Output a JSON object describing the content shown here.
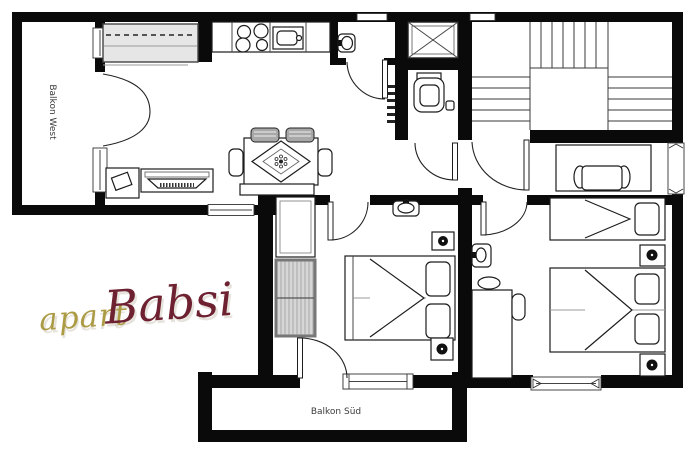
{
  "plan": {
    "labels": {
      "balcony_west": "Balkon West",
      "balcony_south": "Balkon Süd"
    },
    "logo": {
      "part1": "apart",
      "part2": "Babsi",
      "part1_color": "#ac9b45",
      "part2_color": "#6e2130",
      "shadow_color": "#c9c2b2"
    },
    "colors": {
      "wall": "#0a0a0a",
      "background": "#ffffff",
      "furniture_line": "#1c1c1c",
      "wardrobe_fill": "#d6d6d6",
      "sideboard_fill": "#e6e6e6",
      "label_text": "#3c3c3c"
    },
    "furniture_icons": [
      "kitchen-counter",
      "stove",
      "kitchen-sink",
      "shower",
      "toilet",
      "washbasin",
      "stairs",
      "dining-table",
      "dining-chair",
      "bench",
      "sideboard",
      "tv-board",
      "side-table",
      "double-bed",
      "single-bed",
      "wardrobe",
      "cabinet",
      "desk",
      "desk-chair",
      "radiator",
      "heater-outlet"
    ]
  }
}
